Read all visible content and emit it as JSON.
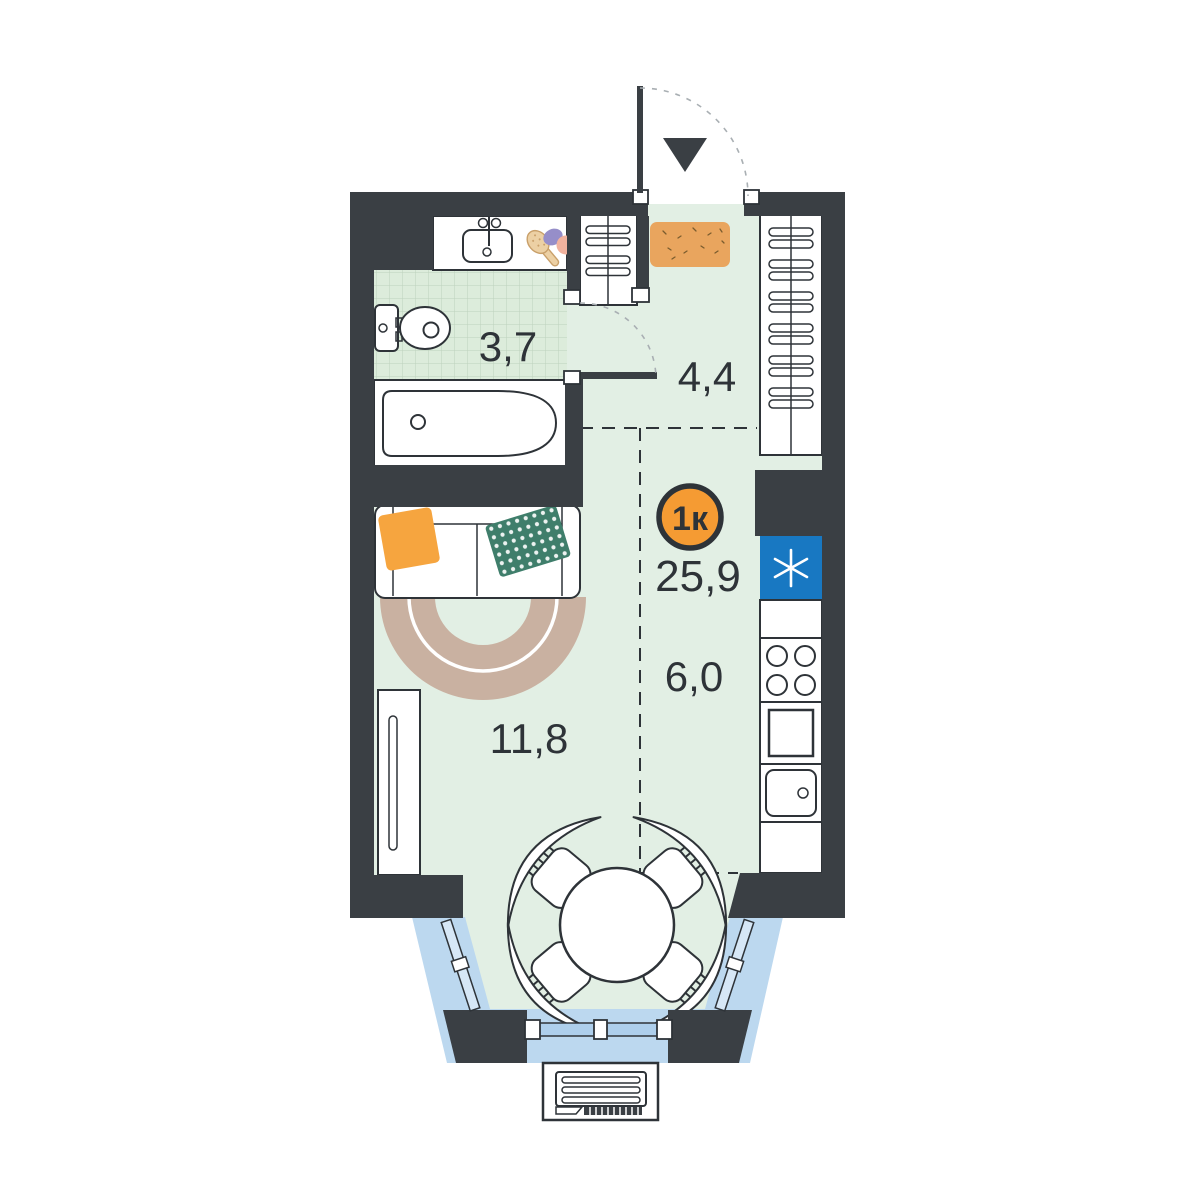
{
  "plan": {
    "badge": {
      "label": "1к",
      "total_area": "25,9"
    },
    "rooms": {
      "bathroom": {
        "area": "3,7"
      },
      "hallway": {
        "area": "4,4"
      },
      "living_room": {
        "area": "11,8"
      },
      "kitchen": {
        "area": "6,0"
      }
    },
    "colors": {
      "wall": "#3a3f44",
      "ink": "#2e3338",
      "floor": "#e2efe4",
      "tile_floor": "#dcecdb",
      "tile_grid": "#bdd2bd",
      "balcony_glass": "#bcd8ef",
      "window_glass": "#aecfec",
      "accent_orange": "#f59b33",
      "doormat_orange": "#e9a55e",
      "fridge_blue": "#1878c2",
      "pillow_orange": "#f6a53f",
      "pillow_teal": "#3f7e6b",
      "rug_tan": "#c9b1a1",
      "brush_tan": "#ecd0a4",
      "soap_purple": "#968ec9",
      "soap_peach": "#f1b29e"
    }
  }
}
